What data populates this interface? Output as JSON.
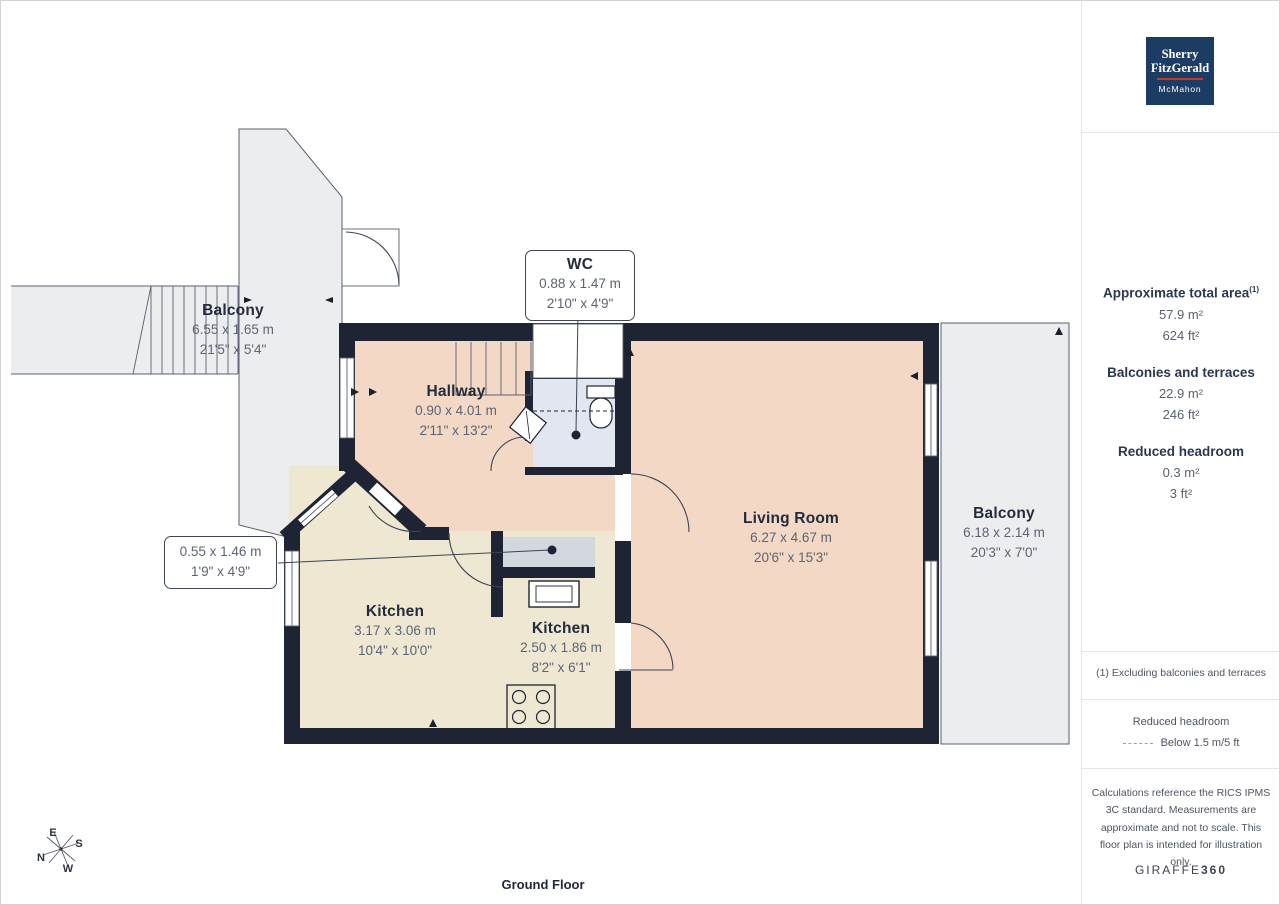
{
  "page": {
    "floor_label": "Ground Floor"
  },
  "logo": {
    "line1": "Sherry",
    "line2": "FitzGerald",
    "line3": "McMahon"
  },
  "sidebar": {
    "total_area_label": "Approximate total area",
    "total_area_sup": "(1)",
    "total_area_m2": "57.9 m²",
    "total_area_ft2": "624 ft²",
    "balconies_label": "Balconies and terraces",
    "balconies_m2": "22.9 m²",
    "balconies_ft2": "246 ft²",
    "reduced_label": "Reduced headroom",
    "reduced_m2": "0.3 m²",
    "reduced_ft2": "3 ft²",
    "footnote": "(1) Excluding balconies and terraces",
    "legend_title": "Reduced headroom",
    "legend_desc": "Below 1.5 m/5 ft",
    "disclaimer": "Calculations reference the RICS IPMS 3C standard. Measurements are approximate and not to scale. This floor plan is intended for illustration only.",
    "brand_name": "GIRAFFE",
    "brand_suffix": "360"
  },
  "plan": {
    "rooms": {
      "balcony_top": {
        "name": "Balcony",
        "metric": "6.55 x 1.65 m",
        "imperial": "21'5\" x 5'4\""
      },
      "hallway": {
        "name": "Hallway",
        "metric": "0.90 x 4.01 m",
        "imperial": "2'11\" x 13'2\""
      },
      "wc": {
        "name": "WC",
        "metric": "0.88 x 1.47 m",
        "imperial": "2'10\" x 4'9\""
      },
      "living_room": {
        "name": "Living Room",
        "metric": "6.27 x 4.67 m",
        "imperial": "20'6\" x 15'3\""
      },
      "balcony_right": {
        "name": "Balcony",
        "metric": "6.18 x 2.14 m",
        "imperial": "20'3\" x 7'0\""
      },
      "kitchen_left": {
        "name": "Kitchen",
        "metric": "3.17 x 3.06 m",
        "imperial": "10'4\" x 10'0\""
      },
      "kitchen_mid": {
        "name": "Kitchen",
        "metric": "2.50 x 1.86 m",
        "imperial": "8'2\" x 6'1\""
      },
      "store": {
        "metric": "0.55 x 1.46 m",
        "imperial": "1'9\" x 4'9\""
      }
    },
    "compass": {
      "e": "E",
      "s": "S",
      "n": "N",
      "w": "W"
    }
  },
  "colors": {
    "wall": "#1e2433",
    "room-pink": "#f3d8c6",
    "room-cream": "#eee8d3",
    "room-wc": "#e1e6f0",
    "balcony-grey": "#ecedee",
    "counter-grey": "#d3d7de",
    "thin-line": "#4a5160",
    "logo-navy": "#1d3c63",
    "logo-red": "#c0392b",
    "text-dark": "#232b3c",
    "text-grey": "#5c6474"
  }
}
